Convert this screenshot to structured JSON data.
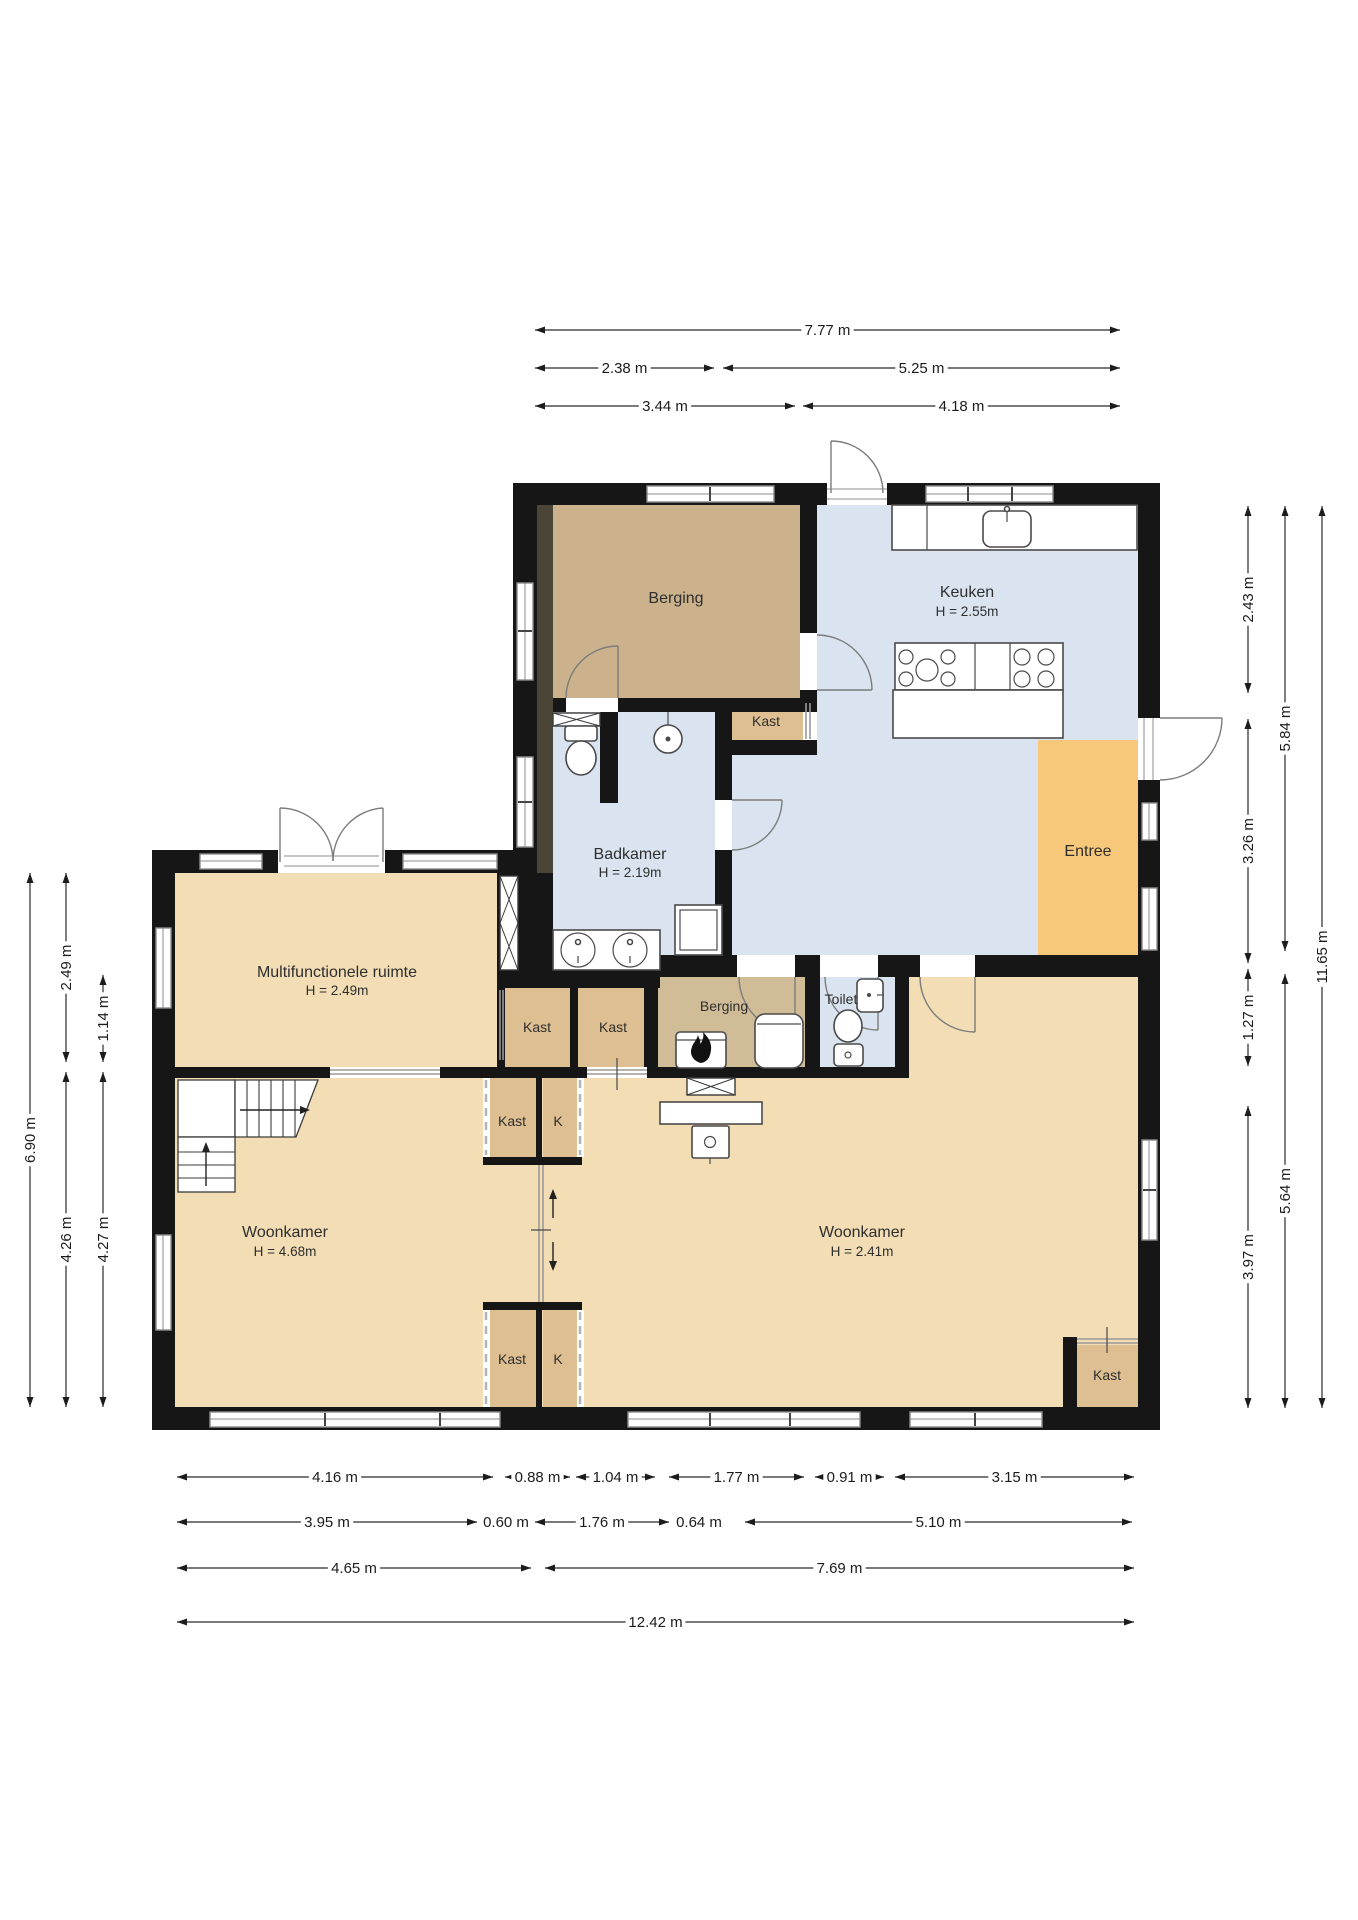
{
  "plan_title": "Begane grond plattegrond",
  "rooms": {
    "berging_groot": {
      "label": "Berging"
    },
    "keuken": {
      "label": "Keuken",
      "height": "H = 2.55m"
    },
    "badkamer": {
      "label": "Badkamer",
      "height": "H = 2.19m"
    },
    "entree": {
      "label": "Entree"
    },
    "multifunctioneel": {
      "label": "Multifunctionele ruimte",
      "height": "H = 2.49m"
    },
    "woonkamer_links": {
      "label": "Woonkamer",
      "height": "H = 4.68m"
    },
    "woonkamer_rechts": {
      "label": "Woonkamer",
      "height": "H = 2.41m"
    },
    "kast_boven": {
      "label": "Kast"
    },
    "kast_midden_1": {
      "label": "Kast"
    },
    "kast_midden_2": {
      "label": "Kast"
    },
    "berging_klein": {
      "label": "Berging"
    },
    "toilet": {
      "label": "Toilet"
    },
    "kast_b1": {
      "label": "Kast"
    },
    "k_b1": {
      "label": "K"
    },
    "kast_c1": {
      "label": "Kast"
    },
    "k_c1": {
      "label": "K"
    },
    "kast_rechtsonder": {
      "label": "Kast"
    }
  },
  "dimensions": {
    "horizontal": [
      {
        "label": "7.77 m",
        "x1": 535,
        "x2": 1120,
        "y": 330
      },
      {
        "label": "2.38 m",
        "x1": 535,
        "x2": 714,
        "y": 368
      },
      {
        "label": "5.25 m",
        "x1": 723,
        "x2": 1120,
        "y": 368
      },
      {
        "label": "3.44 m",
        "x1": 535,
        "x2": 795,
        "y": 406
      },
      {
        "label": "4.18 m",
        "x1": 803,
        "x2": 1120,
        "y": 406
      },
      {
        "label": "4.16 m",
        "x1": 177,
        "x2": 493,
        "y": 1477
      },
      {
        "label": "0.88 m",
        "x1": 505,
        "x2": 570,
        "y": 1477
      },
      {
        "label": "1.04 m",
        "x1": 576,
        "x2": 655,
        "y": 1477
      },
      {
        "label": "1.77 m",
        "x1": 669,
        "x2": 804,
        "y": 1477
      },
      {
        "label": "0.91 m",
        "x1": 815,
        "x2": 884,
        "y": 1477
      },
      {
        "label": "3.15 m",
        "x1": 895,
        "x2": 1134,
        "y": 1477
      },
      {
        "label": "3.95 m",
        "x1": 177,
        "x2": 477,
        "y": 1522
      },
      {
        "label": "0.60 m",
        "x1": 483,
        "x2": 529,
        "y": 1522
      },
      {
        "label": "1.76 m",
        "x1": 535,
        "x2": 669,
        "y": 1522
      },
      {
        "label": "0.64 m",
        "x1": 675,
        "x2": 723,
        "y": 1522
      },
      {
        "label": "5.10 m",
        "x1": 745,
        "x2": 1132,
        "y": 1522
      },
      {
        "label": "4.65 m",
        "x1": 177,
        "x2": 531,
        "y": 1568
      },
      {
        "label": "7.69 m",
        "x1": 545,
        "x2": 1134,
        "y": 1568
      },
      {
        "label": "12.42 m",
        "x1": 177,
        "x2": 1134,
        "y": 1622
      }
    ],
    "vertical": [
      {
        "label": "6.90 m",
        "y1": 873,
        "y2": 1407,
        "x": 30
      },
      {
        "label": "2.49 m",
        "y1": 873,
        "y2": 1062,
        "x": 66
      },
      {
        "label": "4.26 m",
        "y1": 1072,
        "y2": 1407,
        "x": 66
      },
      {
        "label": "1.14 m",
        "y1": 975,
        "y2": 1062,
        "x": 103
      },
      {
        "label": "4.27 m",
        "y1": 1072,
        "y2": 1407,
        "x": 103
      },
      {
        "label": "2.43 m",
        "y1": 506,
        "y2": 693,
        "x": 1248
      },
      {
        "label": "3.26 m",
        "y1": 719,
        "y2": 963,
        "x": 1248
      },
      {
        "label": "1.27 m",
        "y1": 969,
        "y2": 1066,
        "x": 1248
      },
      {
        "label": "3.97 m",
        "y1": 1106,
        "y2": 1408,
        "x": 1248
      },
      {
        "label": "5.84 m",
        "y1": 506,
        "y2": 951,
        "x": 1285
      },
      {
        "label": "5.64 m",
        "y1": 974,
        "y2": 1408,
        "x": 1285
      },
      {
        "label": "11.65 m",
        "y1": 506,
        "y2": 1408,
        "x": 1322
      }
    ]
  },
  "colors": {
    "wall": "#161616",
    "wall_inner": "#4b4537",
    "floor_light": "#f2ddb5",
    "floor_closet": "#ddbf92",
    "floor_berging": "#cbb28d",
    "floor_berging_small": "#d1bc98",
    "floor_wet": "#d9e4f0",
    "floor_entree": "#f8c87a"
  }
}
